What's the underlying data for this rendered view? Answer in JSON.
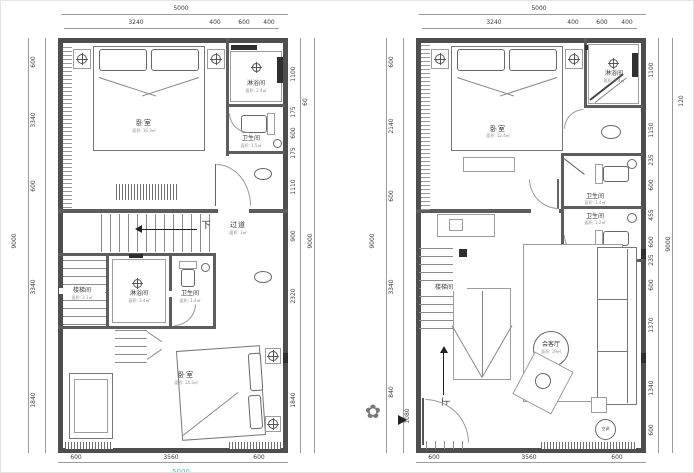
{
  "colors": {
    "wall": "#4e4e4e",
    "line": "#9b9b9b",
    "dim_text": "#3c3c3c",
    "partial_dim_teal": "#55b9d5"
  },
  "plans": [
    {
      "title": "upper-floor-plan",
      "dims": {
        "top_total": "5000",
        "top": [
          "3240",
          "400",
          "600",
          "400"
        ],
        "left_outer": "9000",
        "left": [
          "600",
          "3340",
          "600",
          "3340",
          "1840"
        ],
        "right": [
          "1100",
          "175",
          "600",
          "175",
          "1110",
          "900",
          "2320",
          "1840"
        ],
        "right_outer": "9000",
        "right_outer_small": "60",
        "bottom": [
          "600",
          "3560",
          "600"
        ],
        "bottom_total": "5000"
      },
      "rooms": {
        "bedroom_top": {
          "label": "卧室",
          "area": "面积: 16.3㎡"
        },
        "shower_top": {
          "label": "淋浴间",
          "area": "面积: 2.4㎡"
        },
        "wc_top": {
          "label": "卫生间",
          "area": "面积: 1.5㎡"
        },
        "corridor": {
          "label": "过道",
          "area": "面积: 3㎡"
        },
        "down": "下",
        "stair": {
          "label": "楼梯间",
          "area": "面积: 3.1㎡"
        },
        "shower_mid": {
          "label": "淋浴间",
          "area": "面积: 3.4㎡"
        },
        "wc_mid": {
          "label": "卫生间",
          "area": "面积: 1.4㎡"
        },
        "bedroom_bottom": {
          "label": "卧室",
          "area": "面积: 14.3㎡"
        }
      }
    },
    {
      "title": "lower-floor-plan",
      "dims": {
        "top_total": "5000",
        "top": [
          "3240",
          "400",
          "600",
          "400"
        ],
        "left_outer": "9000",
        "left": [
          "600",
          "2140",
          "600",
          "3340",
          "840"
        ],
        "left_extra": "1080",
        "right": [
          "1100",
          "1150",
          "235",
          "600",
          "455",
          "600",
          "235",
          "600",
          "1370",
          "1340",
          "600"
        ],
        "right_outer": "9000",
        "right_outer_small": "120",
        "bottom": [
          "600",
          "3560",
          "600"
        ]
      },
      "rooms": {
        "bedroom": {
          "label": "卧室",
          "area": "面积: 12.4㎡"
        },
        "shower": {
          "label": "淋浴间",
          "area": "面积: 2.4㎡"
        },
        "wc_top": {
          "label": "卫生间",
          "area": "面积: 1.4㎡"
        },
        "wc_bottom": {
          "label": "卫生间",
          "area": "面积: 1.2㎡"
        },
        "stair": {
          "label": "楼梯间"
        },
        "living": {
          "label": "会客厅",
          "area": "面积: 19㎡"
        },
        "ac": "空调",
        "up": "上"
      }
    }
  ]
}
